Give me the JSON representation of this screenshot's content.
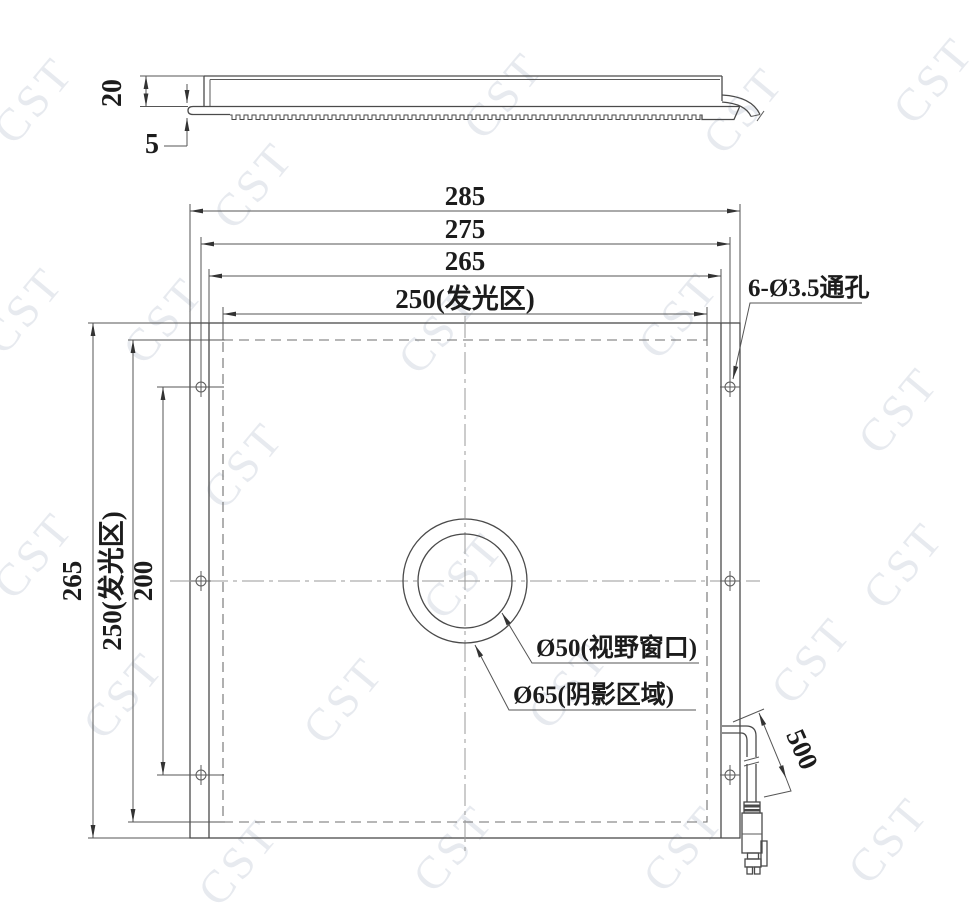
{
  "drawing": {
    "watermark": "CST",
    "side_view": {
      "dim_height": "20",
      "dim_plate": "5"
    },
    "plan_view": {
      "dim_h": [
        "285",
        "275",
        "265",
        "250(发光区)"
      ],
      "dim_v": [
        "265",
        "250(发光区)",
        "200"
      ],
      "label_holes": "6-Ø3.5通孔",
      "label_window": "Ø50(视野窗口)",
      "label_shadow": "Ø65(阴影区域)",
      "dim_cable": "500"
    },
    "colors": {
      "ink": "#4a4a4a",
      "dimension": "#555555",
      "centerline": "#9a9a9a",
      "watermark": "#e7eaef",
      "background": "#ffffff"
    }
  }
}
